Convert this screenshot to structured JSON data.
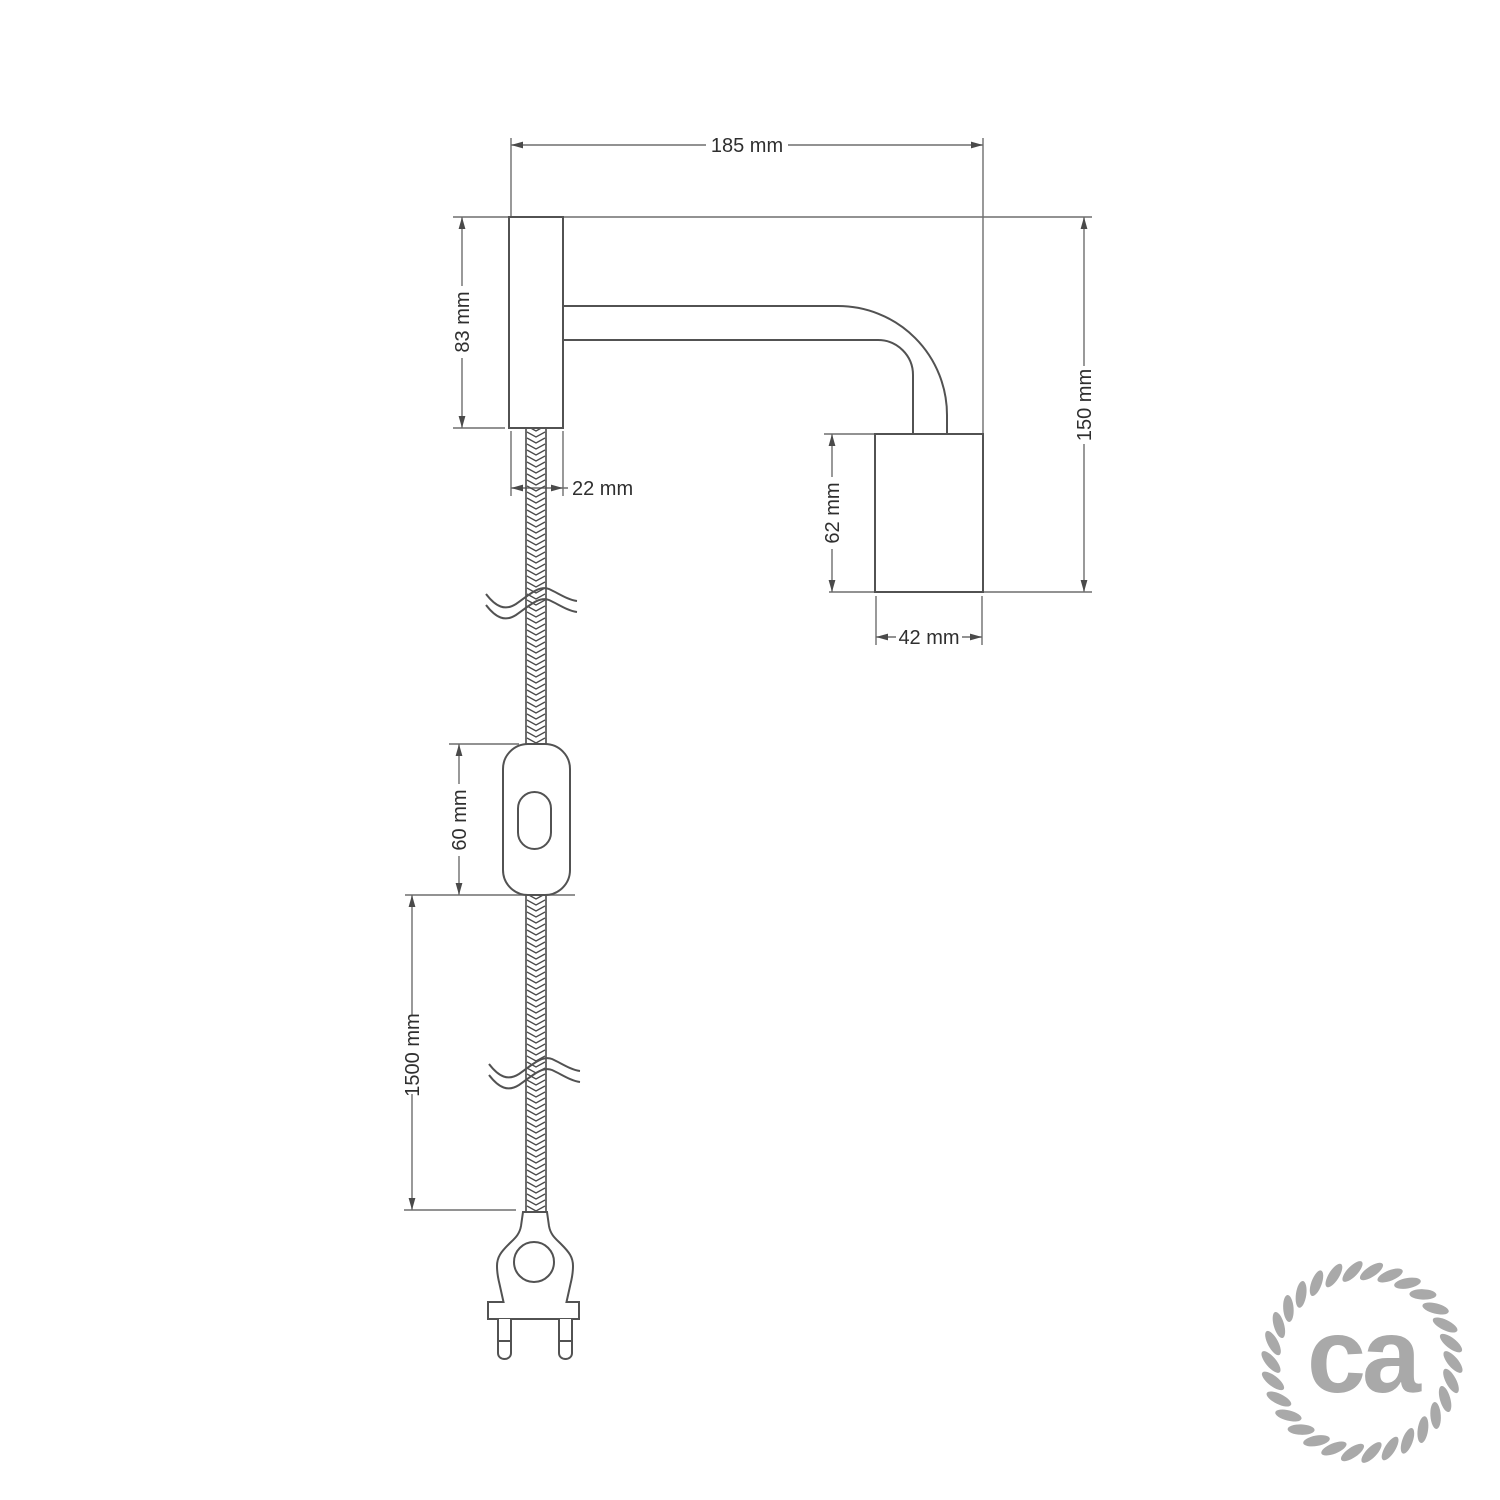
{
  "page": {
    "background_color": "#ffffff"
  },
  "drawing": {
    "type": "technical-dimension-diagram",
    "subject": "wall spotlight with fabric cable, inline switch and two-pin plug",
    "labels": {
      "arm_width": "185 mm",
      "plate_height": "83 mm",
      "cable_exit_width": "22 mm",
      "overall_height": "150 mm",
      "socket_height": "62 mm",
      "socket_width": "42 mm",
      "switch_length": "60 mm",
      "cord_length": "1500 mm"
    },
    "colors": {
      "outline": "#525252",
      "dimension_line": "#6e6e6e",
      "dimension_text": "#2f2f2f",
      "logo_gray": "#a9a9a9",
      "background": "#ffffff"
    }
  },
  "logo": {
    "text": "ca"
  }
}
